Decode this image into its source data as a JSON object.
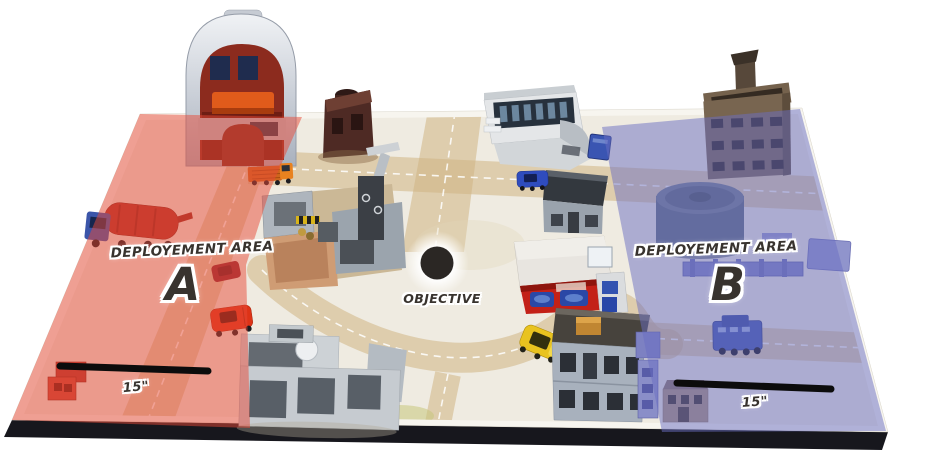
{
  "zone_a": {
    "area_label": "DEPLOYEMENT AREA",
    "letter": "A",
    "ruler_label": "15\""
  },
  "zone_b": {
    "area_label": "DEPLOYEMENT AREA",
    "letter": "B",
    "ruler_label": "15\""
  },
  "objective": {
    "label": "OBJECTIVE"
  },
  "colors": {
    "zone_a_overlay": "#e84a38",
    "zone_b_overlay": "#6a6ec2",
    "objective_dot": "#2b2724",
    "ruler_bar": "#0c0c0c",
    "board_mat": "#efebe1",
    "board_edge": "#17171d",
    "road": "#cfb584"
  },
  "scene": {
    "objects": [
      "dome-building",
      "ruined-tower",
      "walled-compound",
      "white-garage",
      "brown-tower",
      "storage-tank",
      "red-storefront-shop",
      "dark-roof-building",
      "two-story-house",
      "ruined-building",
      "small-house",
      "blue-walls",
      "mixer-truck",
      "orange-truck",
      "dark-red-car",
      "red-car",
      "red-container",
      "blue-car",
      "blue-dumpster",
      "yellow-car",
      "blue-apc",
      "objective-marker"
    ]
  }
}
